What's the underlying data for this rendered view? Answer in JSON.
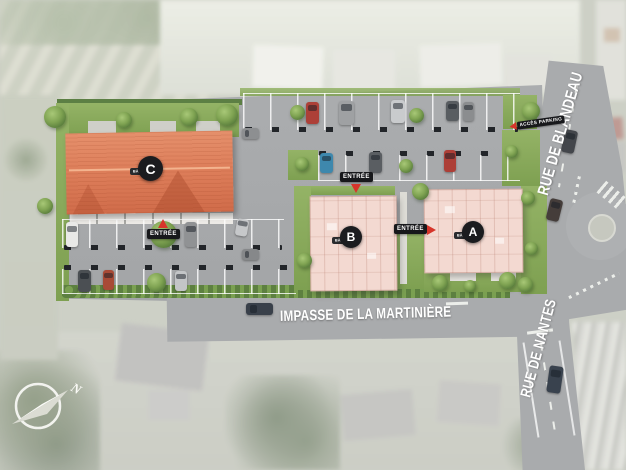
{
  "plan": {
    "streets": {
      "impasse": "IMPASSE DE LA MARTINIÈRE",
      "blandeau": "RUE DE BLANDEAU",
      "nantes": "RUE DE NANTES"
    },
    "buildings": [
      {
        "letter": "A",
        "tag": "BÂT"
      },
      {
        "letter": "B",
        "tag": "BÂT"
      },
      {
        "letter": "C",
        "tag": "BÂT"
      }
    ],
    "labels": {
      "entrance": "ENTRÉE",
      "parking_access": "ACCÈS PARKING",
      "compass_north": "N"
    },
    "colors": {
      "building_c_roof": "#dd7f5b",
      "building_ab_roof": "#f3d9d1",
      "accent_red": "#d6352b",
      "asphalt": "#a8aaac",
      "lawn": "#86a95c"
    }
  }
}
